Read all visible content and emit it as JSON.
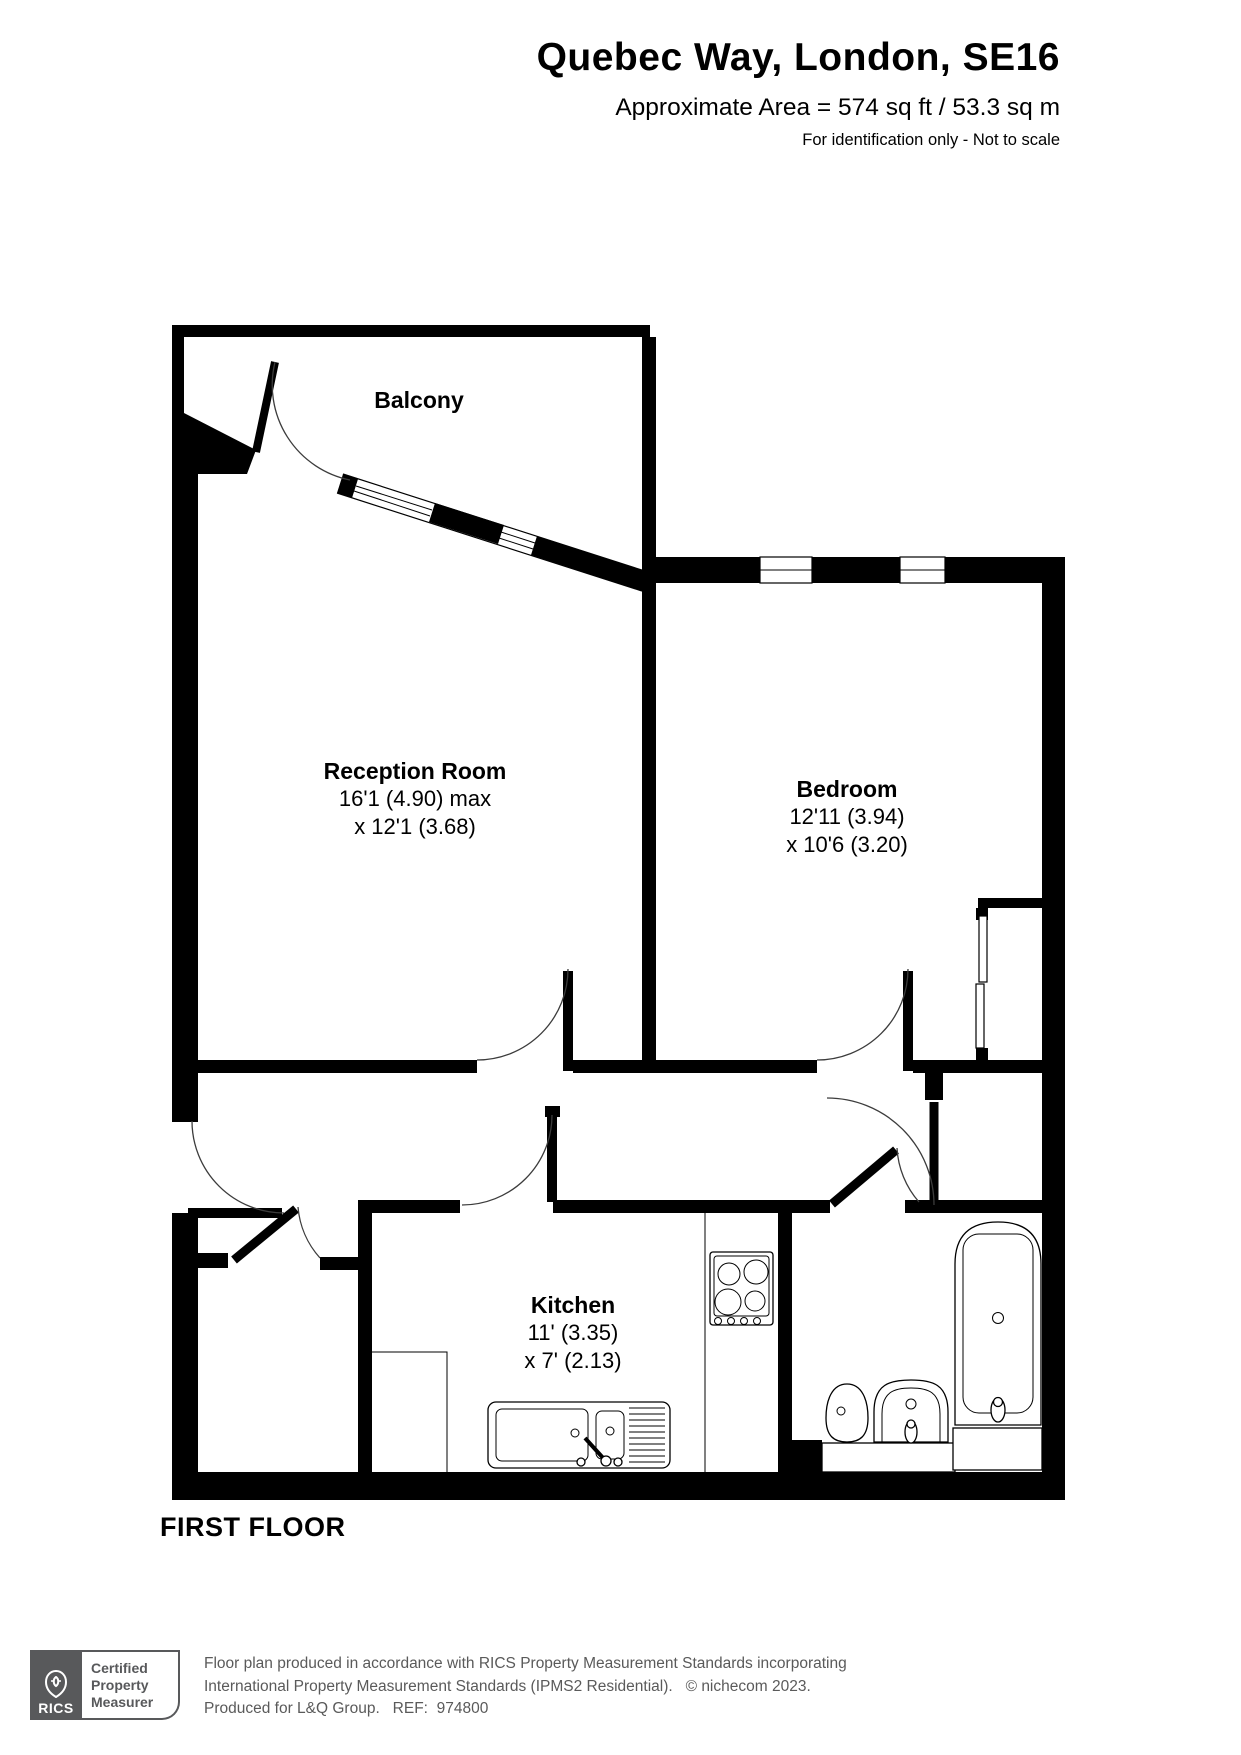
{
  "header": {
    "title": "Quebec Way, London, SE16",
    "area_line": "Approximate Area = 574 sq ft / 53.3 sq m",
    "disclaimer": "For identification only - Not to scale"
  },
  "plan": {
    "floor_label": "FIRST FLOOR",
    "rooms": {
      "balcony": {
        "name": "Balcony"
      },
      "reception": {
        "name": "Reception Room",
        "dims": [
          "16'1 (4.90) max",
          "x 12'1 (3.68)"
        ]
      },
      "bedroom": {
        "name": "Bedroom",
        "dims": [
          "12'11 (3.94)",
          "x 10'6 (3.20)"
        ]
      },
      "kitchen": {
        "name": "Kitchen",
        "dims": [
          "11' (3.35)",
          "x 7' (2.13)"
        ]
      }
    },
    "fixture_icons": [
      "hob-icon",
      "kitchen-sink-icon",
      "toilet-icon",
      "basin-icon",
      "bathtub-icon",
      "wardrobe-icon",
      "door-swing-icon",
      "window-icon"
    ]
  },
  "footer": {
    "rics_logo_text": "RICS",
    "badge_lines": [
      "Certified",
      "Property",
      "Measurer"
    ],
    "lines": [
      "Floor plan produced in accordance with RICS Property Measurement Standards incorporating",
      "International Property Measurement Standards (IPMS2 Residential).   © nichecom 2023.",
      "Produced for L&Q Group.   REF:  974800"
    ]
  },
  "colors": {
    "walls": "#000000",
    "footer_gray": "#58595b",
    "background": "#ffffff"
  }
}
